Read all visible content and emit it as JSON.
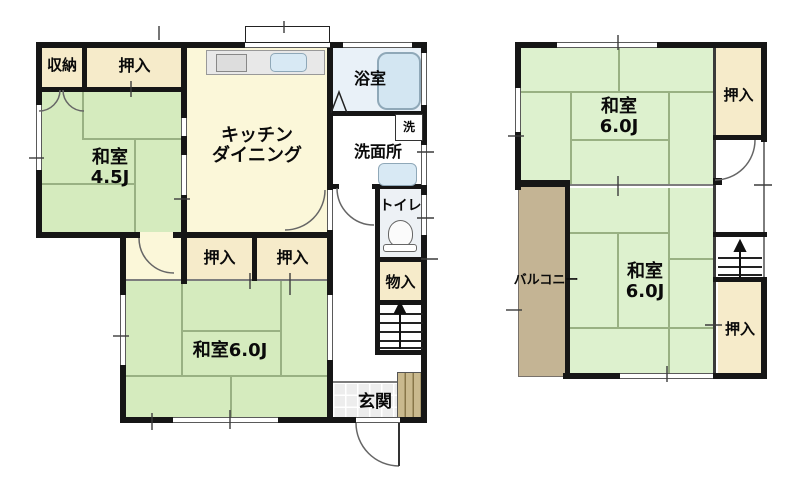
{
  "title": "2-story house floor plan",
  "floor1": {
    "storage": "収納",
    "closet_top": "押入",
    "washitsu45": {
      "name": "和室",
      "size": "4.5J"
    },
    "kitchen": {
      "line1": "キッチン",
      "line2": "ダイニング"
    },
    "bathroom": "浴室",
    "laundry": "洗",
    "washroom": "洗面所",
    "toilet": "トイレ",
    "closet_mid_left": "押入",
    "closet_mid_right": "押入",
    "storage_small": "物入",
    "washitsu60": "和室6.0J",
    "entrance": "玄関"
  },
  "floor2": {
    "washitsu_top": {
      "name": "和室",
      "size": "6.0J"
    },
    "closet_top": "押入",
    "balcony": "バルコニー",
    "washitsu_bottom": {
      "name": "和室",
      "size": "6.0J"
    },
    "closet_bottom": "押入"
  },
  "palette": {
    "wall": "#161616",
    "tatami_1f": "#d5ebbe",
    "tatami_2f": "#ddf1ce",
    "closet_beige": "#f6ebca",
    "kitchen_cream": "#fbf7d9",
    "balcony_tan": "#c4b494",
    "bathroom_blue": "#e9f1f8",
    "fixture_blue": "#d3e6f2",
    "cabinet_tan": "#c9b98e"
  }
}
